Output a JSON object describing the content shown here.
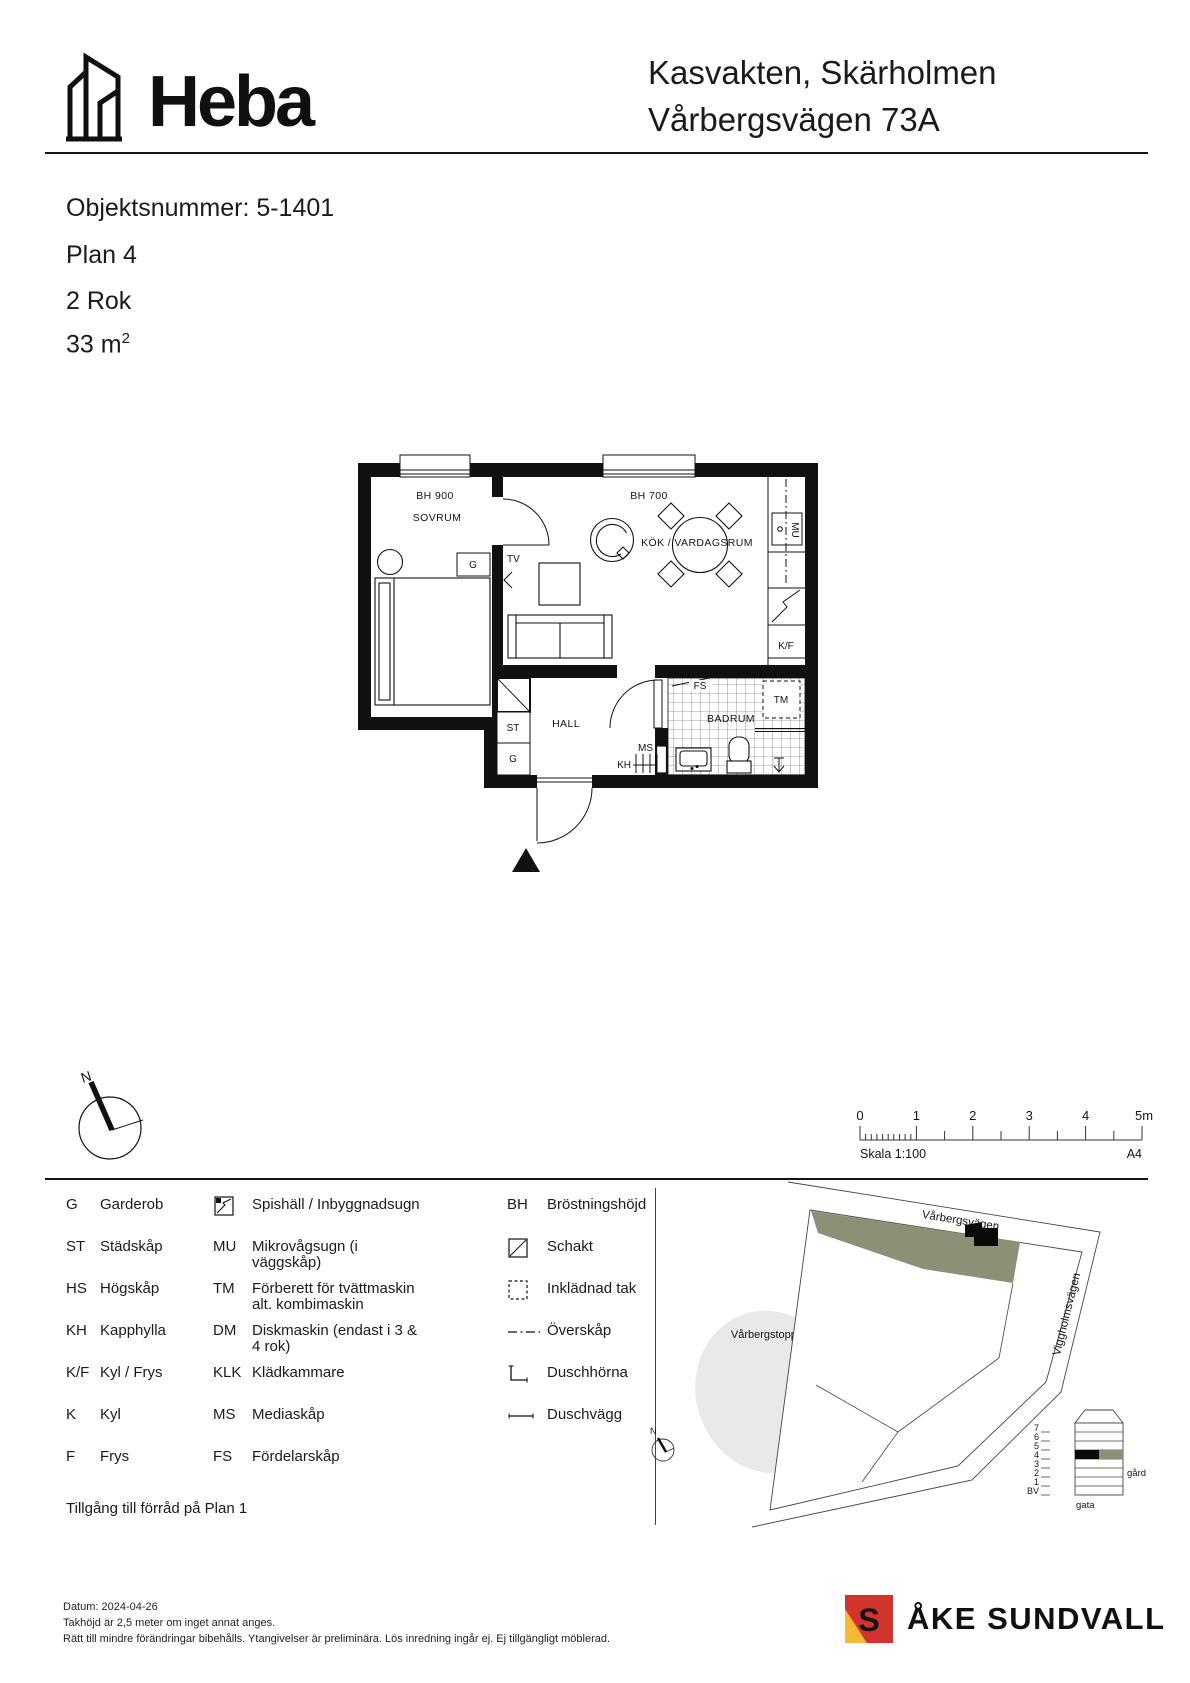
{
  "colors": {
    "ink": "#141414",
    "site_green": "#8A9177",
    "hill_gray": "#E9E9E9",
    "brand_red": "#D0342C",
    "brand_yellow": "#F5B935"
  },
  "header": {
    "logo_text": "Heba",
    "title_line1": "Kasvakten, Skärholmen",
    "title_line2": "Vårbergsvägen 73A"
  },
  "info": {
    "object_number": "Objektsnummer: 5-1401",
    "floor": "Plan 4",
    "rooms": "2 Rok",
    "area": "33 m",
    "area_exponent": "2"
  },
  "floorplan": {
    "rooms": {
      "bedroom": "SOVRUM",
      "kitchen_living": "KÖK / VARDAGSRUM",
      "hall": "HALL",
      "bathroom": "BADRUM"
    },
    "markers": {
      "bh900": "BH 900",
      "bh700": "BH 700",
      "wardrobe": "G",
      "tv": "TV",
      "cleaning_cab": "ST",
      "hall_wardrobe": "G",
      "media_cab": "MS",
      "coat_shelf": "KH",
      "dist_cab": "FS",
      "washer": "TM",
      "microwave": "MU",
      "fridge_freezer": "K/F"
    }
  },
  "compass": {
    "north": "N"
  },
  "scalebar": {
    "ticks": [
      "0",
      "1",
      "2",
      "3",
      "4",
      "5m"
    ],
    "scale_text": "Skala 1:100",
    "paper": "A4"
  },
  "legend": {
    "col1": [
      {
        "abbr": "G",
        "term": "Garderob"
      },
      {
        "abbr": "ST",
        "term": "Städskåp"
      },
      {
        "abbr": "HS",
        "term": "Högskåp"
      },
      {
        "abbr": "KH",
        "term": "Kapphylla"
      },
      {
        "abbr": "K/F",
        "term": "Kyl / Frys"
      },
      {
        "abbr": "K",
        "term": "Kyl"
      },
      {
        "abbr": "F",
        "term": "Frys"
      }
    ],
    "col2": [
      {
        "icon": "stove-oven-icon",
        "term": "Spishäll / Inbyggnadsugn"
      },
      {
        "abbr": "MU",
        "term": "Mikrovågsugn (i väggskåp)"
      },
      {
        "abbr": "TM",
        "term": "Förberett för tvättmaskin alt. kombimaskin"
      },
      {
        "abbr": "DM",
        "term": "Diskmaskin (endast i 3 & 4 rok)"
      },
      {
        "abbr": "KLK",
        "term": "Klädkammare"
      },
      {
        "abbr": "MS",
        "term": "Mediaskåp"
      },
      {
        "abbr": "FS",
        "term": "Fördelarskåp"
      }
    ],
    "col3": [
      {
        "abbr": "BH",
        "term": "Bröstningshöjd"
      },
      {
        "icon": "schakt-icon",
        "term": "Schakt"
      },
      {
        "icon": "inkladnad-tak-icon",
        "term": "Inklädnad tak"
      },
      {
        "icon": "overskap-icon",
        "term": "Överskåp"
      },
      {
        "icon": "duschhorna-icon",
        "term": "Duschhörna"
      },
      {
        "icon": "duschvagg-icon",
        "term": "Duschvägg"
      }
    ],
    "note": "Tillgång till förråd på Plan 1"
  },
  "sitemap": {
    "street_top": "Vårbergsvägen",
    "street_right": "Viggholmsvägen",
    "hill": "Vårbergstoppen",
    "north": "N",
    "section": {
      "floors": [
        "7",
        "6",
        "5",
        "4",
        "3",
        "2",
        "1"
      ],
      "bv": "BV",
      "gard": "gård",
      "gata": "gata"
    }
  },
  "footer": {
    "date": "Datum: 2024-04-26",
    "line2": "Takhöjd är 2,5 meter om inget annat anges.",
    "line3": "Rätt till mindre förändringar bibehålls. Ytangivelser är preliminära. Lös inredning ingår ej. Ej tillgängligt möblerad.",
    "brand": "ÅKE SUNDVALL"
  }
}
